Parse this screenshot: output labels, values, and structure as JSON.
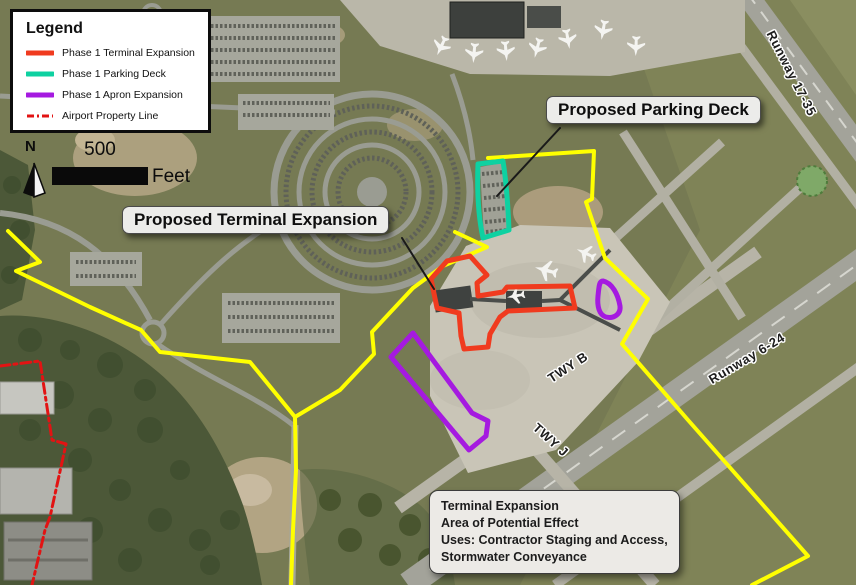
{
  "colors": {
    "property_boundary": "#ffff00",
    "airport_property_line": "#e21313",
    "terminal_expansion": "#f03b1f",
    "parking_deck": "#0ed1a1",
    "apron_expansion": "#a51ae0",
    "leader_line": "#1a1a1a"
  },
  "legend": {
    "title": "Legend",
    "items": [
      {
        "label": "Phase 1 Terminal Expansion",
        "color": "#f03b1f"
      },
      {
        "label": "Phase 1 Parking Deck",
        "color": "#0ed1a1"
      },
      {
        "label": "Phase 1 Apron Expansion",
        "color": "#a51ae0"
      },
      {
        "label": "Airport Property Line",
        "color": "#e21313"
      }
    ]
  },
  "scale_bar": {
    "north_label": "N",
    "distance_label": "500",
    "unit_label": "Feet"
  },
  "callouts": {
    "parking_deck_label": "Proposed Parking Deck",
    "terminal_expansion_label": "Proposed Terminal Expansion"
  },
  "info_box": {
    "lines": [
      "Terminal Expansion",
      "Area of Potential Effect",
      "Uses: Contractor Staging and Access,",
      "Stormwater Conveyance"
    ]
  },
  "map_labels": {
    "runway_17_35": "Runway 17-35",
    "runway_6_24": "Runway 6-24",
    "taxiway_b": "TWY B",
    "taxiway_j": "TWY J"
  }
}
